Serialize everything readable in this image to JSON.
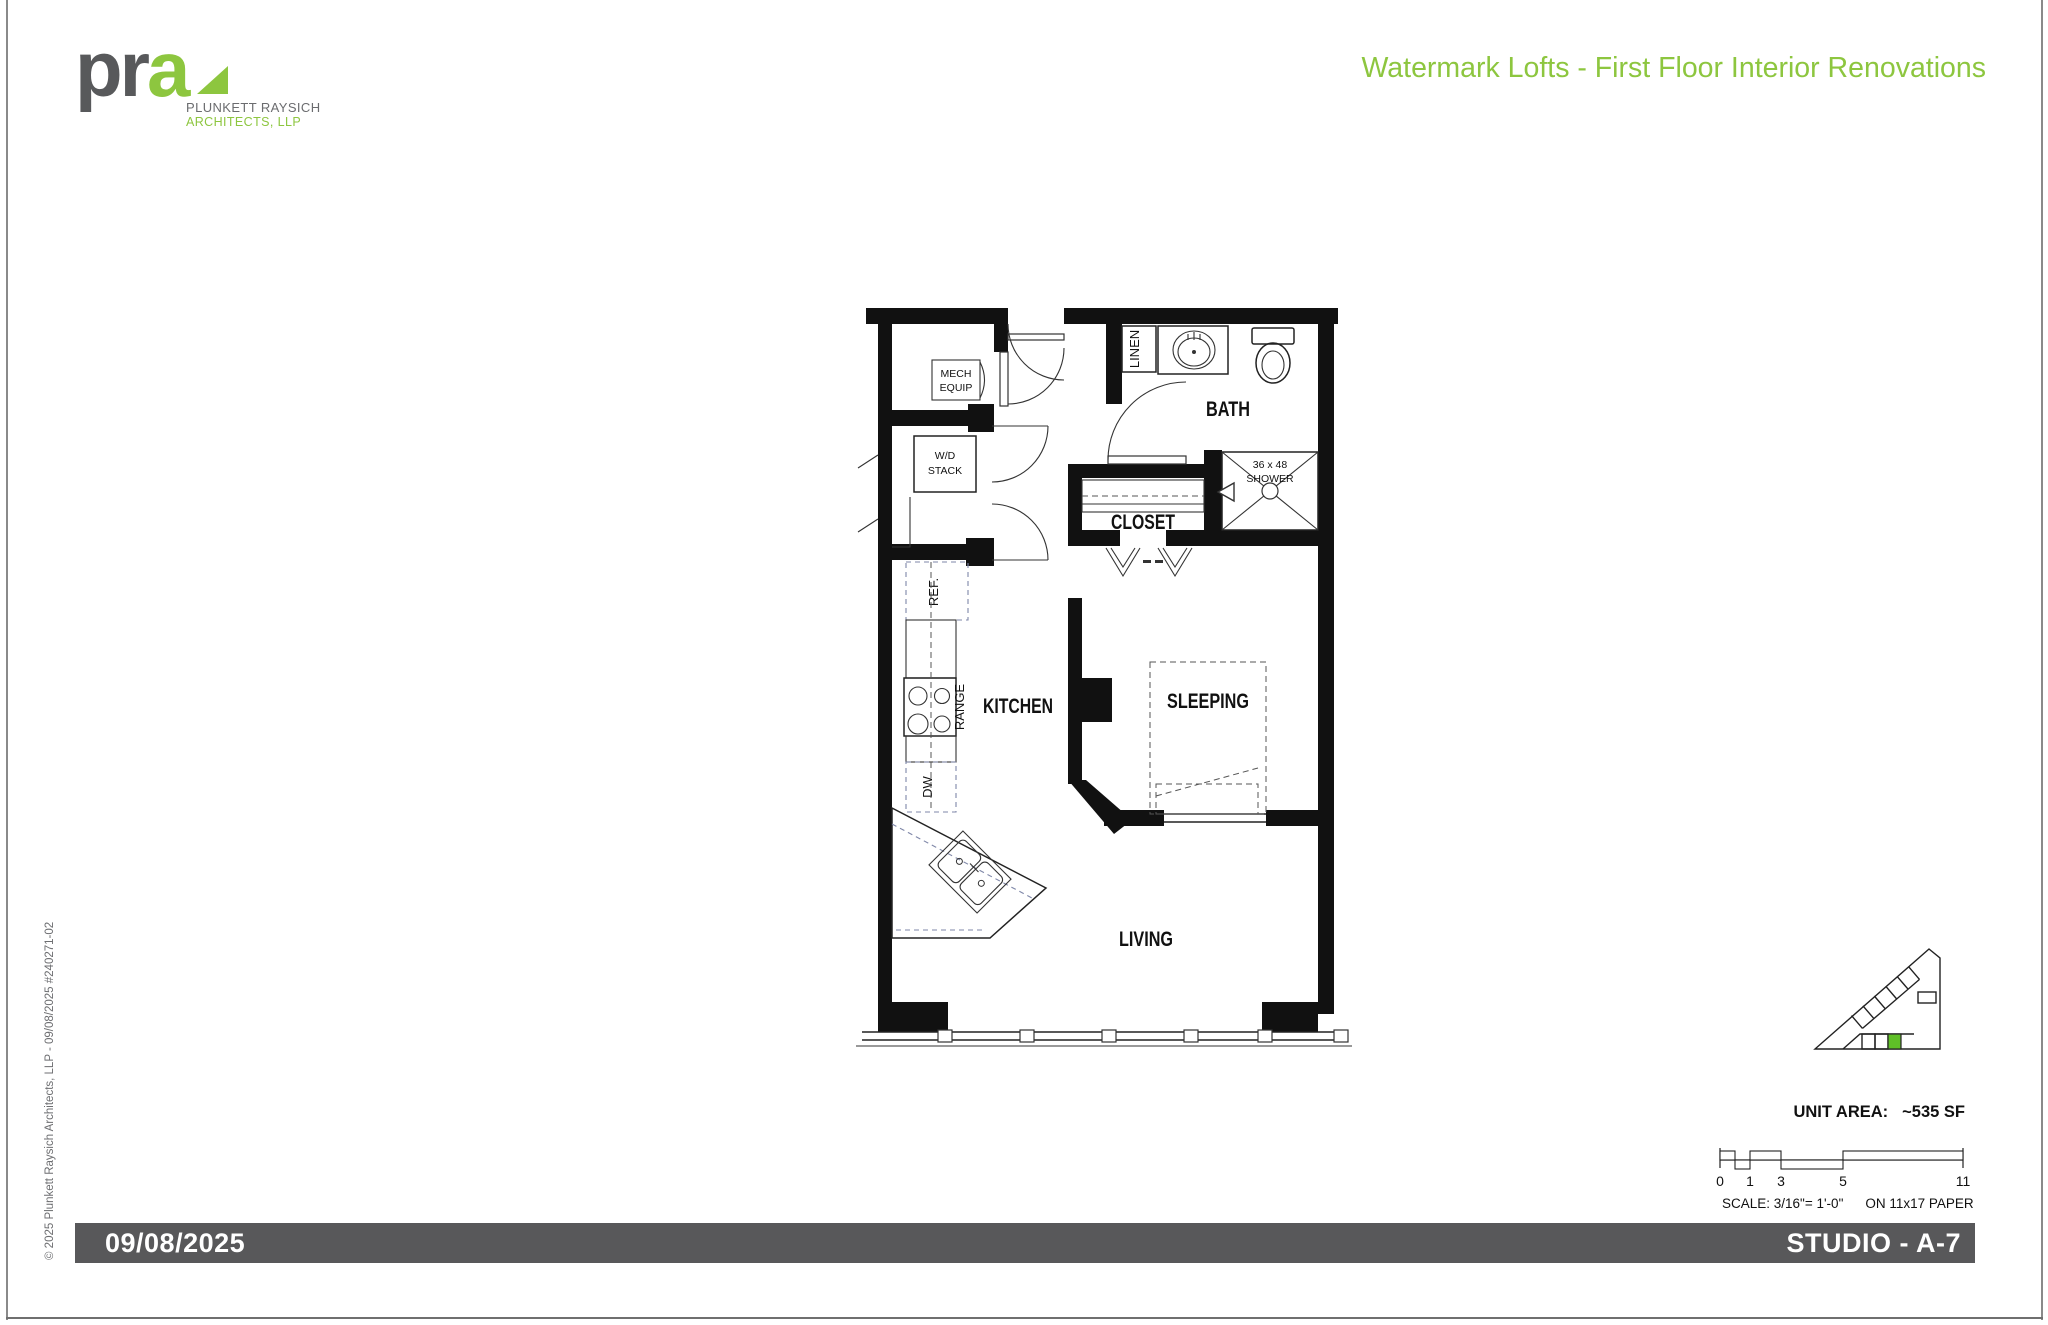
{
  "header": {
    "logo_pr": "pr",
    "logo_a": "a",
    "logo_line1": "PLUNKETT RAYSICH",
    "logo_line2": "ARCHITECTS, LLP",
    "title": "Watermark Lofts - First Floor Interior Renovations"
  },
  "plan": {
    "labels": {
      "mech1": "MECH",
      "mech2": "EQUIP",
      "wd1": "W/D",
      "wd2": "STACK",
      "linen": "LINEN",
      "bath": "BATH",
      "shower1": "36 x 48",
      "shower2": "SHOWER",
      "closet": "CLOSET",
      "ref": "REF.",
      "range": "RANGE",
      "dw": "DW",
      "kitchen": "KITCHEN",
      "sleeping": "SLEEPING",
      "living": "LIVING"
    }
  },
  "key_plan": {
    "unit_area_label": "UNIT AREA:",
    "unit_area_value": "~535 SF",
    "scale_ticks": [
      "0",
      "1",
      "3",
      "5",
      "11"
    ],
    "scale_note": "SCALE: 3/16\"= 1'-0\"",
    "paper_note": "ON 11x17 PAPER"
  },
  "side_note": "© 2025 Plunkett Raysich Architects, LLP  -  09/08/2025  #240271-02",
  "footer": {
    "date": "09/08/2025",
    "sheet_title": "STUDIO - A-7"
  },
  "colors": {
    "brand_green": "#8DC63F",
    "logo_gray": "#58595B",
    "bar_gray": "#58585A",
    "keyplan_unit_green": "#5FBF27",
    "plan_line": "#111111"
  }
}
